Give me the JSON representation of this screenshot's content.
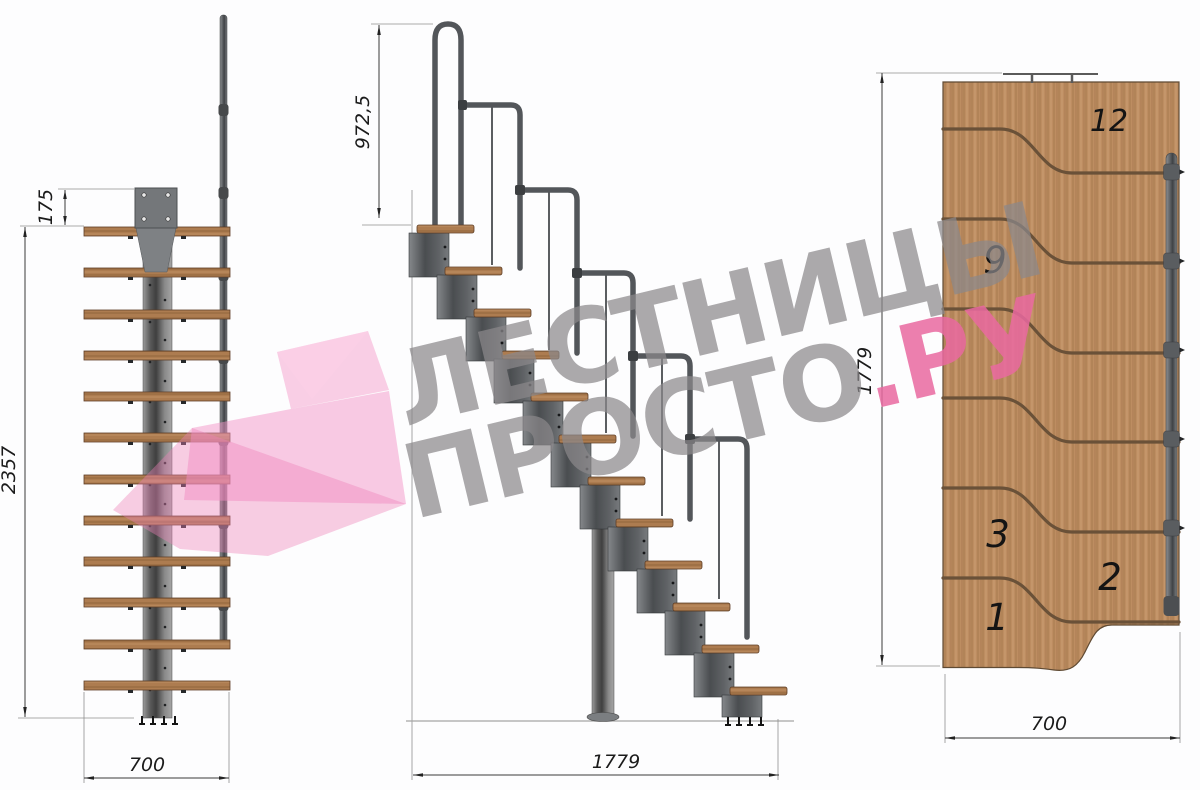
{
  "title": "Чертёж модульной лестницы — три проекции",
  "watermark": {
    "line1": "ЛЕСТНИЦЫ",
    "line2_gray": "ПРОСТО",
    "line2_pink": ".РУ"
  },
  "front_view": {
    "label": "вид спереди",
    "dim_plate_offset": "175",
    "dim_total_height": "2357",
    "dim_width": "700"
  },
  "side_view": {
    "label": "вид сбоку",
    "dim_handrail_height": "972,5",
    "dim_total_length": "1779"
  },
  "plan_view": {
    "label": "вид сверху",
    "dim_total_length": "1779",
    "dim_width": "700",
    "step_numbers": [
      "12",
      "9",
      "3",
      "2",
      "1"
    ]
  },
  "colors": {
    "watermark_gray": "#8a888b",
    "accent_pink": "#e968a0",
    "logo_pink": "#f48fc0",
    "wood": "#bd8d61",
    "metal": "#53565a",
    "background": "#fdfdfe"
  }
}
